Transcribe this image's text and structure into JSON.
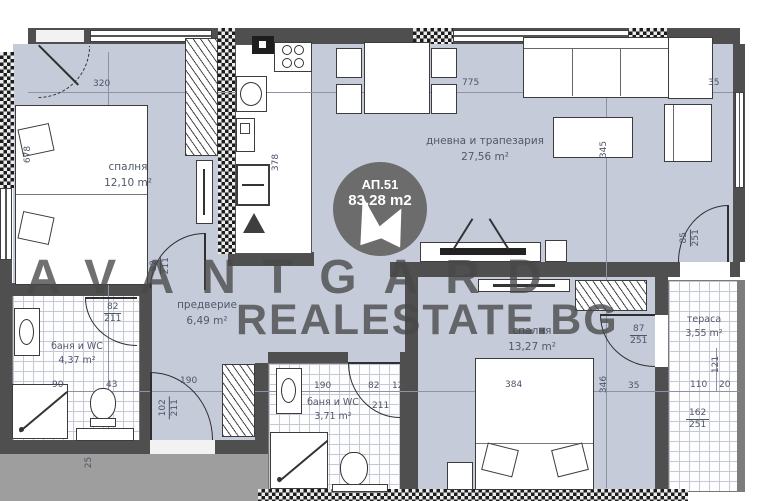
{
  "apartment": {
    "id": "АП.51",
    "area": "83,28 m2"
  },
  "watermark": {
    "brand": "AVANTGARD",
    "site": "REALESTATE.BG"
  },
  "rooms": {
    "bedroom1": {
      "name": "спалня",
      "area": "12,10 m²"
    },
    "living": {
      "name": "дневна и трапезария",
      "area": "27,56 m²"
    },
    "hallway": {
      "name": "предверие",
      "area": "6,49 m²"
    },
    "bathroom1": {
      "name": "баня и WC",
      "area": "4,37 m²"
    },
    "bathroom2": {
      "name": "баня и WC",
      "area": "3,71 m²"
    },
    "bedroom2": {
      "name": "спалня",
      "area": "13,27 m²"
    },
    "terrace": {
      "name": "тераса",
      "area": "3,55 m²"
    }
  },
  "doors": {
    "bedroom1": {
      "w": "82",
      "h": "211"
    },
    "bathroom1": {
      "w": "82",
      "h": "211"
    },
    "entrance": {
      "w": "102",
      "h": "211"
    },
    "bedroom2": {
      "w": "87",
      "h": "251"
    },
    "terrace": {
      "w": "85",
      "h": "251"
    }
  },
  "dims": {
    "bedroom1_width": "320",
    "living_width": "775",
    "corner_right": "35",
    "kitchen_depth": "378",
    "living_depth": "345",
    "bed1_length": "678",
    "bath1_a": "90",
    "bath1_b": "43",
    "hall_wardrobe": "190",
    "bath2_w": "190",
    "bath2_a": "82",
    "bath2_b": "12",
    "bath2_door_h": "211",
    "bed2_width": "384",
    "bedroom2_depth": "346",
    "bedroom2_wall": "35",
    "terrace_a": "121",
    "terrace_b": "110",
    "terrace_c": "20",
    "terrace_d": "162",
    "terrace_e": "251",
    "entry_step": "25"
  },
  "colors": {
    "floor": "#c6cbd9",
    "wall": "#4f4f4f",
    "outside": "#9e9e9e"
  }
}
